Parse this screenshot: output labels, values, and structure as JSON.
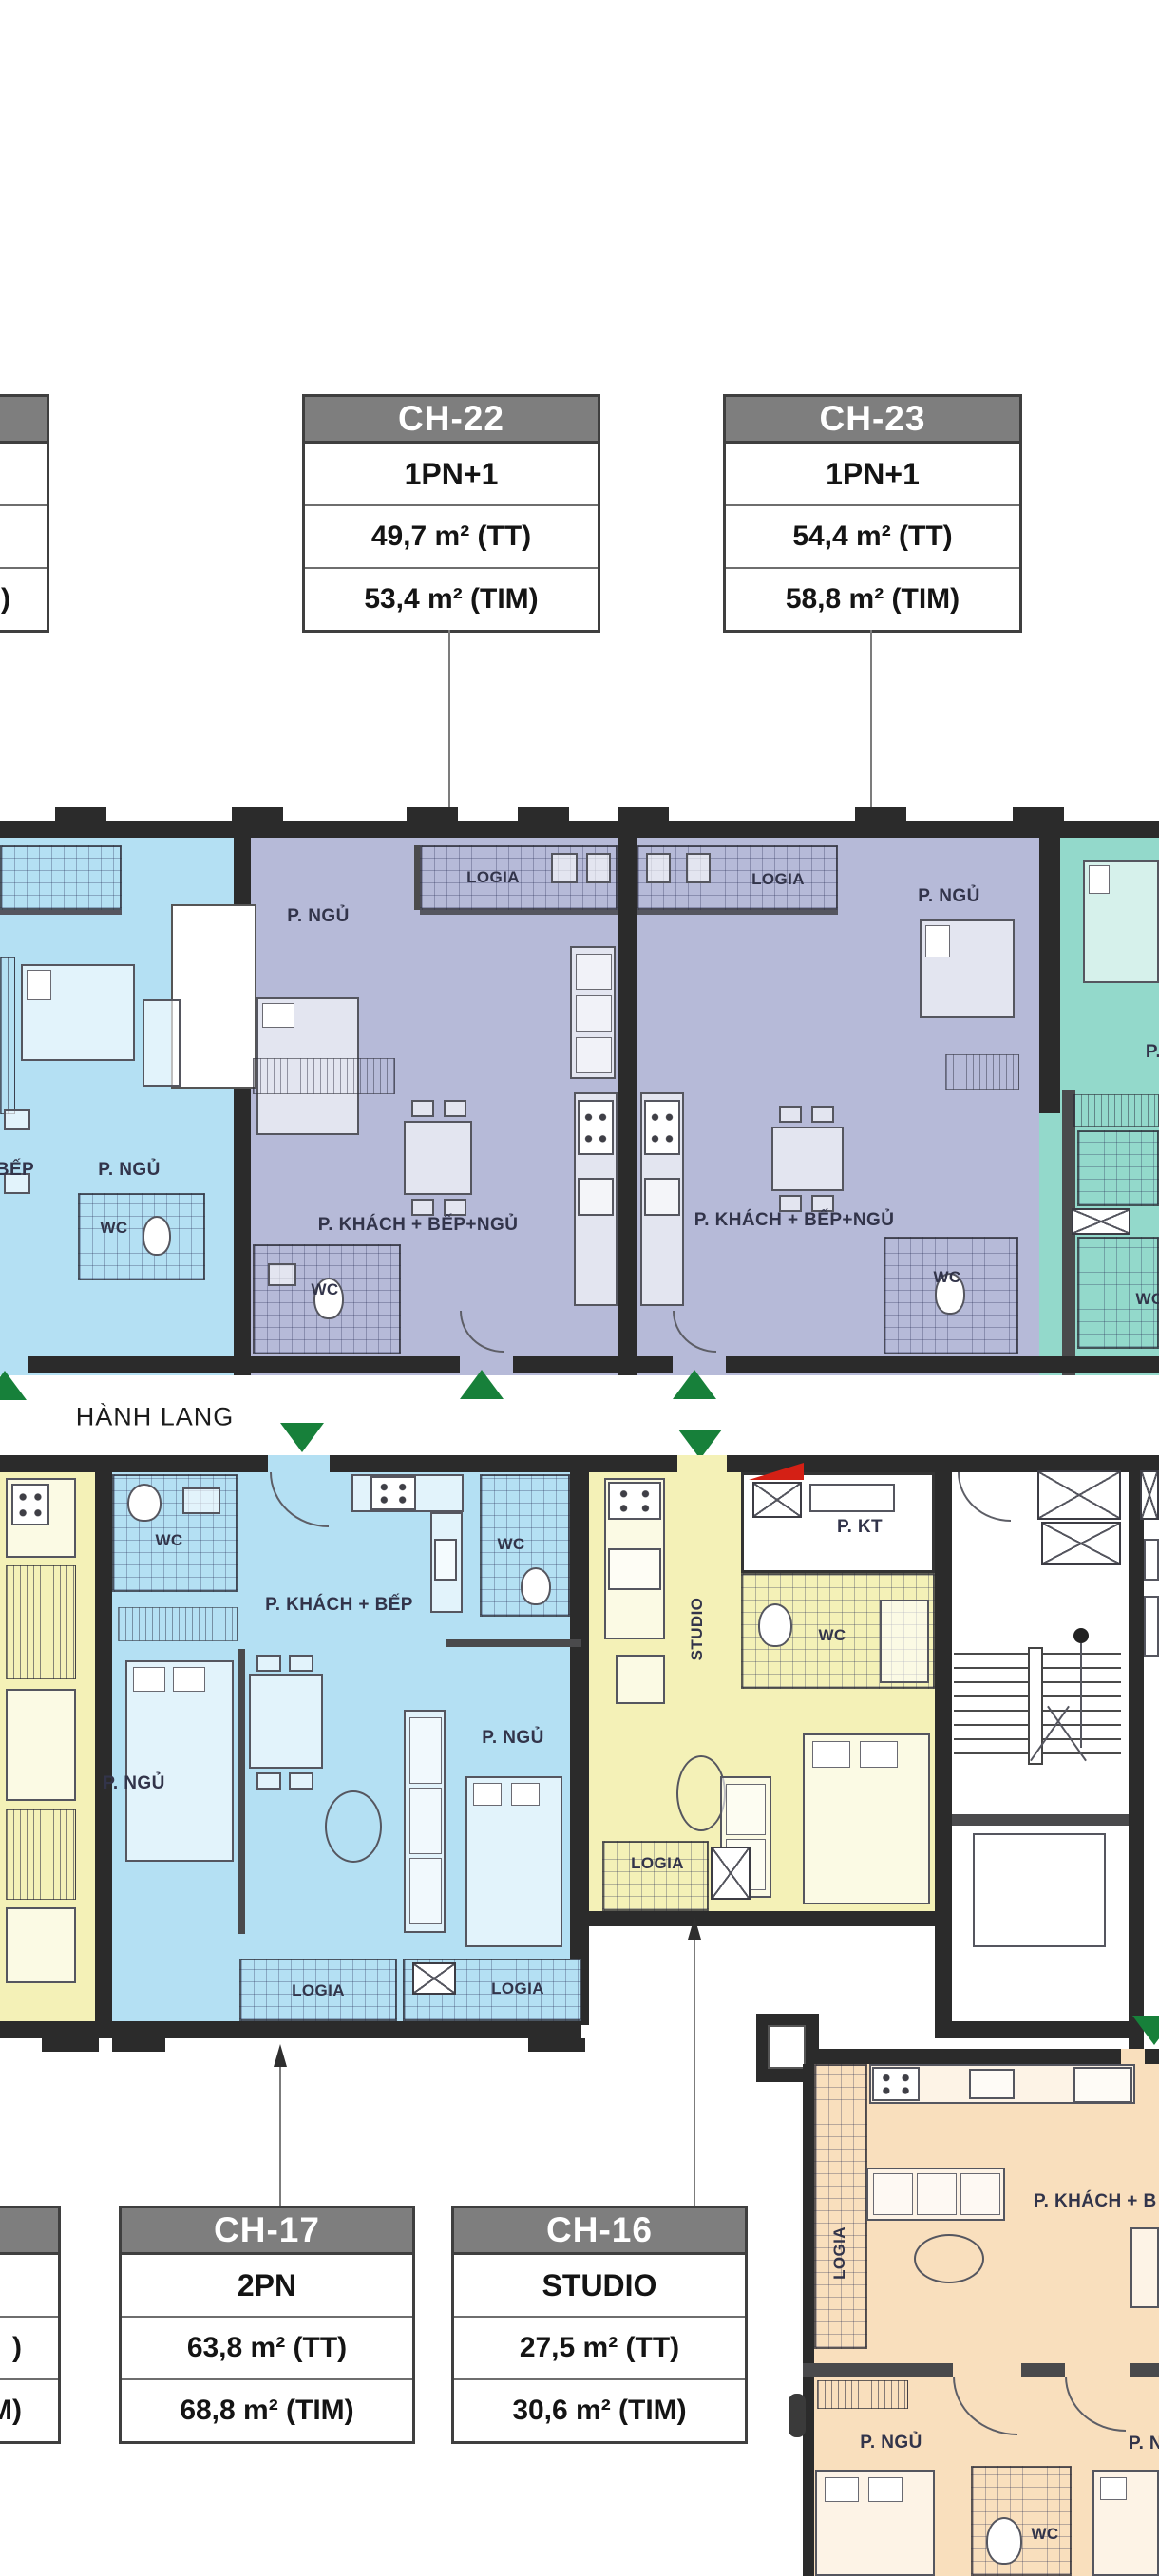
{
  "colors": {
    "lavender": "#b6bad8",
    "blue": "#b4e0f3",
    "teal": "#93d9cb",
    "yellow": "#f4f1b7",
    "peach": "#f9dfbd",
    "wall": "#2b2b2b",
    "green": "#17803a",
    "red": "#d42015",
    "box_header_bg": "#7e7e7e",
    "box_header_text": "#ffffff"
  },
  "info_boxes": [
    {
      "id": "left-top-partial",
      "unit": "",
      "type": "",
      "area_tt": "",
      "area_tim": ")"
    },
    {
      "id": "ch22",
      "unit": "CH-22",
      "type": "1PN+1",
      "area_tt": "49,7 m² (TT)",
      "area_tim": "53,4 m² (TIM)"
    },
    {
      "id": "ch23",
      "unit": "CH-23",
      "type": "1PN+1",
      "area_tt": "54,4 m² (TT)",
      "area_tim": "58,8 m² (TIM)"
    },
    {
      "id": "left-bottom-partial",
      "unit": "",
      "type": "",
      "area_tt": ")",
      "area_tim": "M)"
    },
    {
      "id": "ch17",
      "unit": "CH-17",
      "type": "2PN",
      "area_tt": "63,8 m² (TT)",
      "area_tim": "68,8 m² (TIM)"
    },
    {
      "id": "ch16",
      "unit": "CH-16",
      "type": "STUDIO",
      "area_tt": "27,5 m² (TT)",
      "area_tim": "30,6 m² (TIM)"
    }
  ],
  "corridor_label": "HÀNH LANG",
  "room_labels": [
    {
      "id": "logia-ch22",
      "text": "LOGIA"
    },
    {
      "id": "logia-ch23",
      "text": "LOGIA"
    },
    {
      "id": "pngu-ch22",
      "text": "P. NGỦ"
    },
    {
      "id": "pngu-ch23",
      "text": "P. NGỦ"
    },
    {
      "id": "pngu-blue-left",
      "text": "P. NGỦ"
    },
    {
      "id": "bep-blue-left",
      "text": "BẾP"
    },
    {
      "id": "wc-blue-left",
      "text": "WC"
    },
    {
      "id": "pkbn-ch22",
      "text": "P. KHÁCH + BẾP+NGỦ"
    },
    {
      "id": "pkbn-ch23",
      "text": "P. KHÁCH + BẾP+NGỦ"
    },
    {
      "id": "wc-ch22",
      "text": "WC"
    },
    {
      "id": "wc-ch23",
      "text": "WC"
    },
    {
      "id": "p-teal-partial",
      "text": "P."
    },
    {
      "id": "wc-teal-partial",
      "text": "WC"
    },
    {
      "id": "hanh-lang",
      "text": "HÀNH LANG"
    },
    {
      "id": "wc-ch17-left",
      "text": "WC"
    },
    {
      "id": "wc-ch17-right",
      "text": "WC"
    },
    {
      "id": "pkb-ch17",
      "text": "P. KHÁCH + BẾP"
    },
    {
      "id": "pngu-ch17-left",
      "text": "P. NGỦ"
    },
    {
      "id": "pngu-ch17-right",
      "text": "P. NGỦ"
    },
    {
      "id": "logia-ch17-left",
      "text": "LOGIA"
    },
    {
      "id": "logia-ch17-right",
      "text": "LOGIA"
    },
    {
      "id": "studio-ch16",
      "text": "STUDIO"
    },
    {
      "id": "pkt-ch16",
      "text": "P. KT"
    },
    {
      "id": "wc-ch16",
      "text": "WC"
    },
    {
      "id": "logia-ch16",
      "text": "LOGIA"
    },
    {
      "id": "pkb-orange",
      "text": "P. KHÁCH + B"
    },
    {
      "id": "logia-orange",
      "text": "LOGIA"
    },
    {
      "id": "pngu-orange",
      "text": "P. NGỦ"
    },
    {
      "id": "pn-orange-partial",
      "text": "P. N"
    },
    {
      "id": "wc-orange",
      "text": "WC"
    }
  ]
}
